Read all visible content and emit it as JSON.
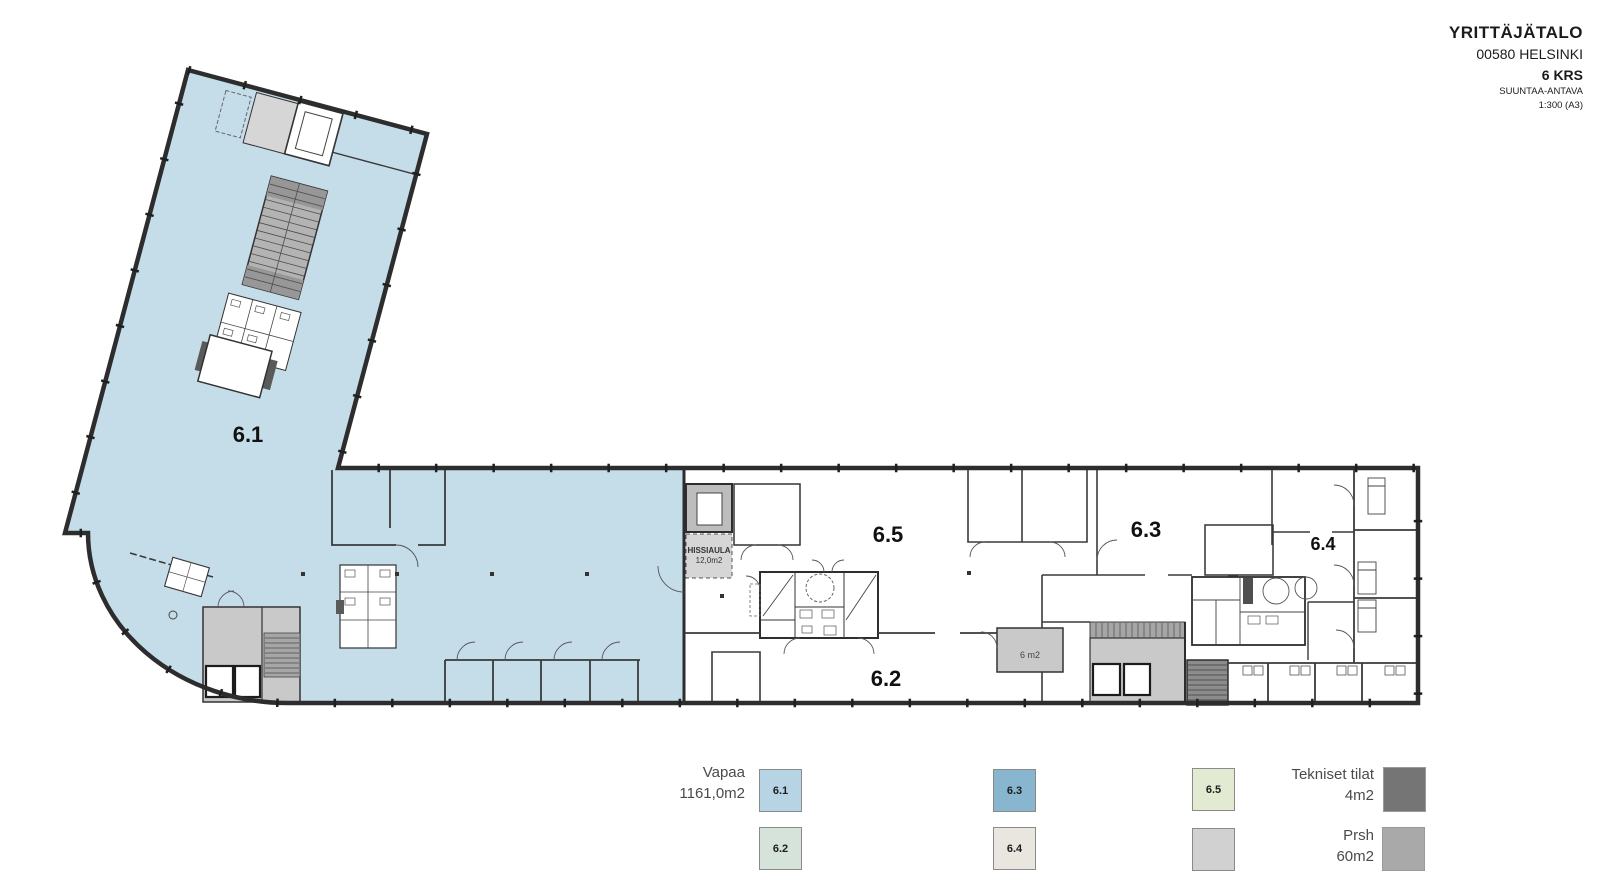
{
  "title_block": {
    "building": "YRITTÄJÄTALO",
    "address": "00580 HELSINKI",
    "floor": "6 KRS",
    "note": "SUUNTAA-ANTAVA",
    "scale": "1:300 (A3)"
  },
  "plan_labels": {
    "area_61": "6.1",
    "area_62": "6.2",
    "area_63": "6.3",
    "area_64": "6.4",
    "area_65": "6.5",
    "hissiaula_line1": "HISSIAULA",
    "hissiaula_line2": "12,0m2",
    "room_6m2": "6 m2"
  },
  "legend": {
    "vapaa_label": "Vapaa",
    "vapaa_area": "1161,0m2",
    "swatches": [
      {
        "label": "6.1",
        "color": "#b7d4e5"
      },
      {
        "label": "6.2",
        "color": "#d6e3da"
      },
      {
        "label": "6.3",
        "color": "#87b6ce"
      },
      {
        "label": "6.4",
        "color": "#e9e6e0"
      },
      {
        "label": "6.5",
        "color": "#e2ebd2"
      },
      {
        "label": "",
        "color": "#d1d1d1"
      }
    ],
    "tekniset_label": "Tekniset tilat",
    "tekniset_area": "4m2",
    "tekniset_color": "#757575",
    "prsh_label": "Prsh",
    "prsh_area": "60m2",
    "prsh_color": "#a9a9a9"
  },
  "colors": {
    "vacant_fill": "#c5dce9",
    "wall": "#2d2d2d",
    "core_fill": "#c9c9c9",
    "stair_fill": "#a6a6a6",
    "stair_dark": "#8c8c8c"
  }
}
